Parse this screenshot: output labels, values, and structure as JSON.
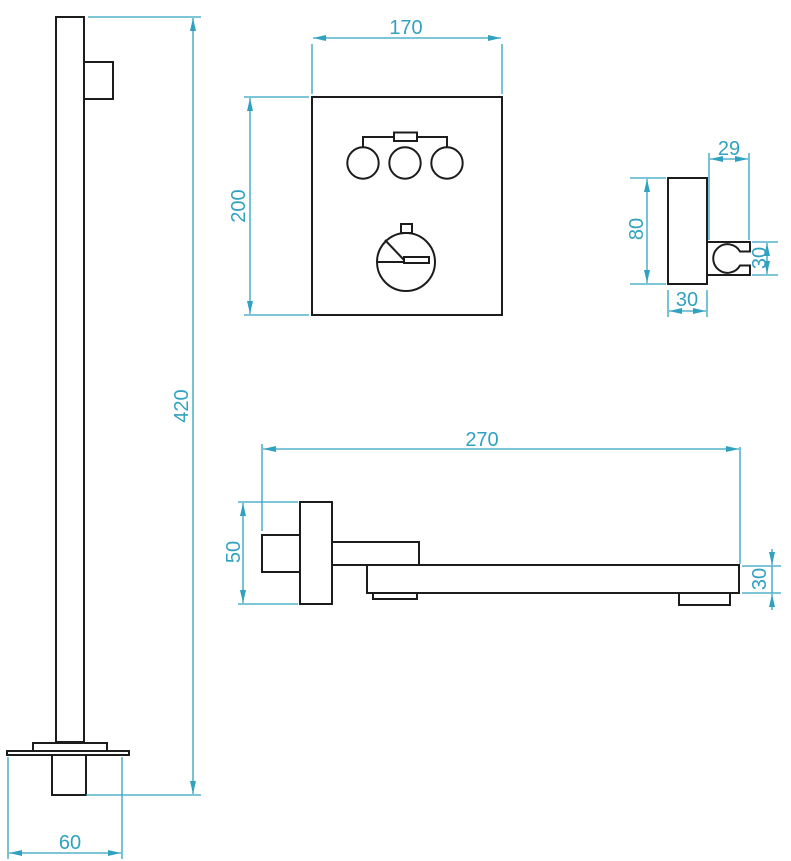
{
  "colors": {
    "dimension": "#30a2c0",
    "outline": "#1c1c1c",
    "background": "#ffffff"
  },
  "dimensions": {
    "column": {
      "height": "420",
      "base_width": "60"
    },
    "panel": {
      "width": "170",
      "height": "200"
    },
    "holder": {
      "top_depth": "29",
      "height": "80",
      "bottom_width": "30",
      "clip_height": "30"
    },
    "spout": {
      "length": "270",
      "plate_height": "50",
      "bar_height": "30"
    }
  }
}
